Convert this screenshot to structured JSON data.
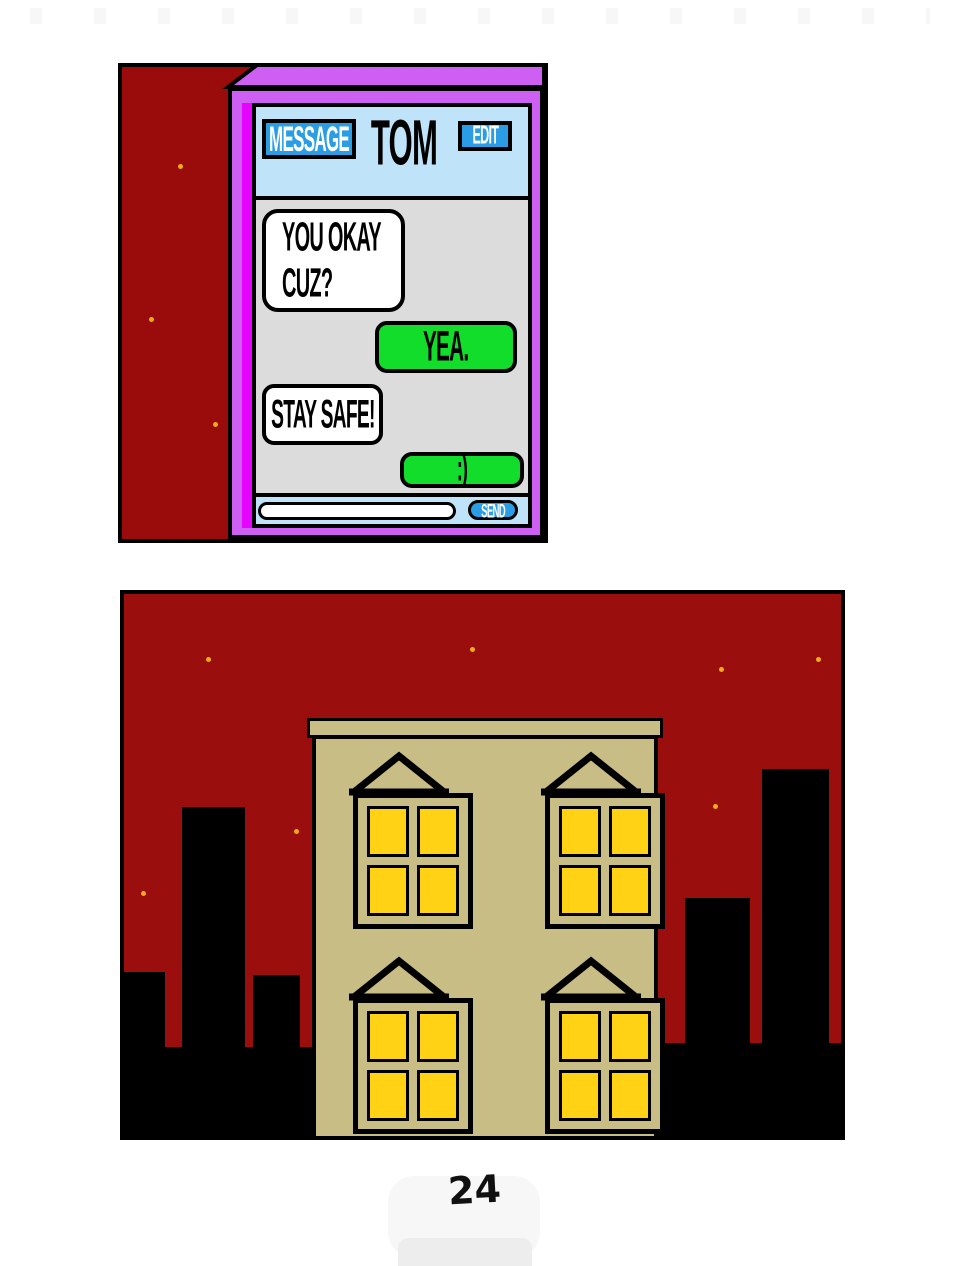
{
  "page": {
    "number": "24",
    "background_color": "#ffffff"
  },
  "panel1": {
    "background_color": "#9a0c0c",
    "star_color": "#f2ab1a",
    "phone": {
      "frame_color": "#cd5ff2",
      "accent_strip_color": "#e605fc",
      "header": {
        "background_color": "#bfe3f8",
        "message_button_label": "MESSAGE",
        "contact_name": "TOM",
        "edit_button_label": "EDIT",
        "button_color": "#2a9de4"
      },
      "chat": {
        "background_color": "#dcdcdc",
        "incoming_bubble_color": "#ffffff",
        "outgoing_bubble_color": "#13dd2b",
        "messages": [
          {
            "from": "contact",
            "line1": "YOU OKAY",
            "line2": "CUZ?"
          },
          {
            "from": "user",
            "line1": "YEA."
          },
          {
            "from": "contact",
            "line1": "STAY SAFE!"
          },
          {
            "from": "user",
            "line1": ":)"
          }
        ]
      },
      "footer": {
        "background_color": "#bfe3f8",
        "input_value": "",
        "input_placeholder": "",
        "send_button_label": "SEND"
      }
    }
  },
  "panel2": {
    "sky_color": "#9b0e0e",
    "building_color": "#c9bd86",
    "window_pane_color": "#ffd215",
    "silhouette_color": "#000000",
    "lit_window_count": 4,
    "star_color": "#f2ab1a"
  }
}
